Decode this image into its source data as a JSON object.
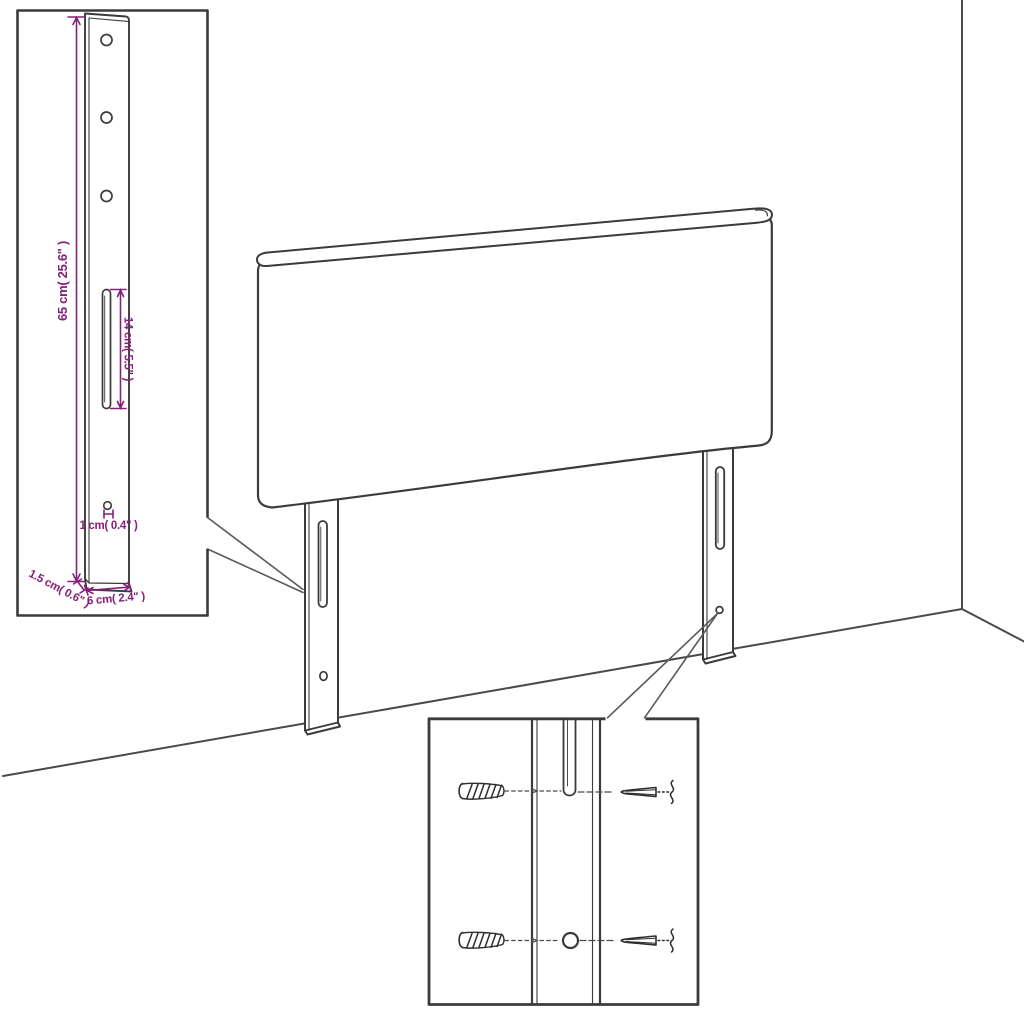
{
  "diagram": {
    "title": "Headboard with adjustable legs - dimension diagram",
    "colors": {
      "line": "#3b3b3b",
      "dimension": "#86207c",
      "background": "#ffffff"
    },
    "inset": {
      "name": "leg bracket magnified view",
      "labels": {
        "height": "65 cm( 25.6\" )",
        "slot_length": "14 cm( 5.5\" )",
        "hole": "1 cm( 0.4\" )",
        "thickness": "1.5 cm( 0.6\" )",
        "width": "6 cm( 2.4\" )"
      }
    },
    "detail_box": {
      "name": "wall mounting screw detail"
    }
  }
}
